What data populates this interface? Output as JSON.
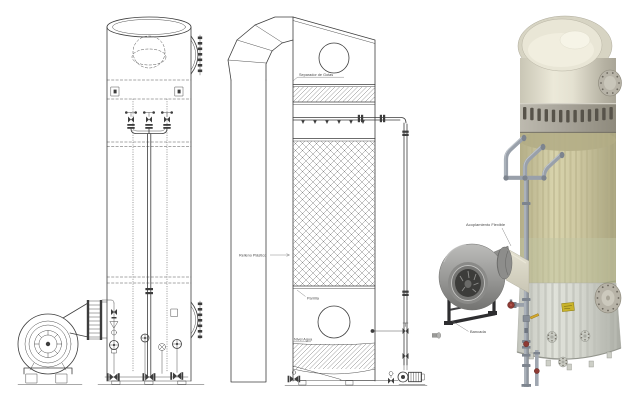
{
  "labels": {
    "separador_de_gotas": "Separador de Gotas",
    "relleno_plastico": "Relleno Plástico",
    "parrilla": "Parrilla",
    "nivel_agua": "Nivel Agua",
    "acoplamiento_flexible": "Acoplamiento Flexible",
    "bancada": "Bancada"
  },
  "colors": {
    "line": "#3d3d3d",
    "text": "#4a4a4a",
    "shell_cream": "#dedbca",
    "shell_cream_light": "#efecdc",
    "shell_cream_dark": "#b2ae9e",
    "band_gray": "#a5a196",
    "band_slot": "#57534a",
    "packing_tan": "#d3cda6",
    "packing_stripe": "#b8b289",
    "packing_green": "#c2c6a3",
    "skirt_gray": "#d7d9d1",
    "skirt_rib": "#c2c4bc",
    "flange_gray": "#b7b3a7",
    "pipe_metal": "#99a0aa",
    "pipe_metal_light": "#c7cdd3",
    "pipe_metal_dark": "#646b73",
    "fan_gray": "#9b9b99",
    "fan_dark": "#3c3c3a",
    "stand_dark": "#2e2e30",
    "duct_cream": "#dcd9c8",
    "label_yellow": "#c9b32a",
    "valve_red": "#8e3a34"
  }
}
